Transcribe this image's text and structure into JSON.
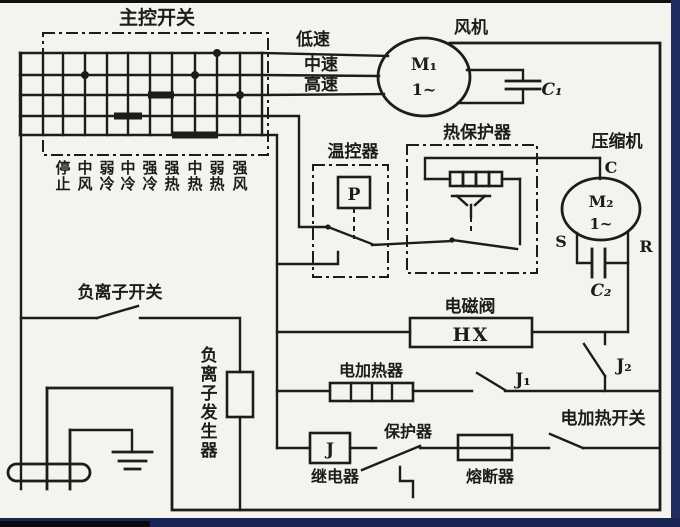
{
  "page": {
    "bg": "#f4f3ee",
    "ink": "#1c1c1c",
    "edge_top": "#101010",
    "edge_right": "#202b5e",
    "edge_bottom": "#1a2452"
  },
  "main_switch": {
    "title": "主控开关",
    "positions": [
      "停止",
      "中风",
      "弱冷",
      "中冷",
      "强冷",
      "强热",
      "中热",
      "弱热",
      "强风"
    ]
  },
  "speeds": {
    "low": "低速",
    "mid": "中速",
    "high": "高速"
  },
  "fan": {
    "label": "风机",
    "motor": "M₁",
    "phase": "1~",
    "cap": "C₁"
  },
  "thermostat": {
    "label": "温控器",
    "sensor": "P"
  },
  "thermal_protector": {
    "label": "热保护器"
  },
  "compressor": {
    "label": "压缩机",
    "motor": "M₂",
    "phase": "1~",
    "cap": "C₂",
    "terminal_c": "C",
    "terminal_s": "S",
    "terminal_r": "R"
  },
  "solenoid": {
    "label": "电磁阀",
    "code": "HX",
    "contact": "J₂"
  },
  "heater": {
    "label": "电加热器",
    "contact": "J₁"
  },
  "relay": {
    "code": "J",
    "label": "继电器"
  },
  "protector": {
    "label": "保护器"
  },
  "fuse": {
    "label": "熔断器"
  },
  "heat_switch": {
    "label": "电加热开关"
  },
  "ion": {
    "switch_label": "负离子开关",
    "generator": "负离子发生器"
  }
}
